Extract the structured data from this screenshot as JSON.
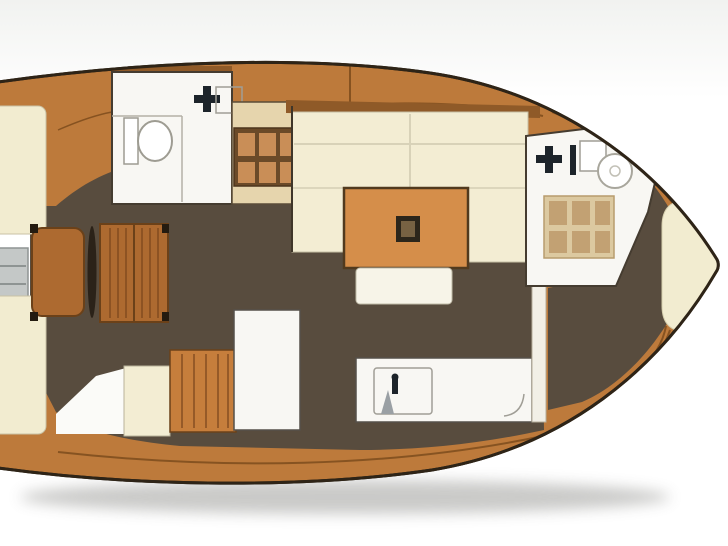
{
  "meta": {
    "image_type": "boat-floorplan",
    "description": "Top-down interior layout rendering of a sailing yacht, bow pointing right, no visible text labels",
    "orientation": {
      "bow": "right",
      "stern": "left"
    }
  },
  "regions": [
    {
      "id": "cockpit",
      "label": "cockpit with benches, helm seat, wheel and wood table"
    },
    {
      "id": "aft-head",
      "label": "aft head with toilet, sink and shower stall with teak grate"
    },
    {
      "id": "salon",
      "label": "U-shaped settee around orange table with center post"
    },
    {
      "id": "galley",
      "label": "counters with sink, stove unit and stowage"
    },
    {
      "id": "forward-head",
      "label": "forward head with sink, round fixture and light teak grate"
    },
    {
      "id": "bow-cabin",
      "label": "bow cabin with cream berth pad"
    }
  ],
  "icons": [
    "toilet-icon",
    "faucet-cross-icon",
    "sink-basin-icon",
    "shower-grate-icon",
    "steering-wheel-icon",
    "swim-ladder-icon",
    "galley-sink-icon",
    "faucet-icon"
  ],
  "colors": {
    "bg": "#ffffff",
    "backdrop": "#f1f2f0",
    "hull-outline": "#2e2417",
    "deck-wood": "#bd7a3b",
    "deck-strip": "#8f5a28",
    "deck-seam": "#7d4c1d",
    "floor": "#584c3e",
    "upholstery": "#f3edd3",
    "berth": "#f2ecd0",
    "fixture-white": "#f8f7f3",
    "fixture-outline": "#a09e96",
    "wall": "#453c30",
    "table-orange": "#d58e4a",
    "table-edge": "#513a1e",
    "wood-furniture": "#ad6a30",
    "wood-edge": "#6b4119",
    "grate-dark-bg": "#6b4a28",
    "grate-dark-cell": "#c98e57",
    "grate-light-bg": "#dcc9a0",
    "grate-light-cell": "#c2a173",
    "stall": "#e6d5ad",
    "metal": "#c4c8c7",
    "dark-icon": "#1d242a",
    "shadow": "#8a8a86"
  }
}
